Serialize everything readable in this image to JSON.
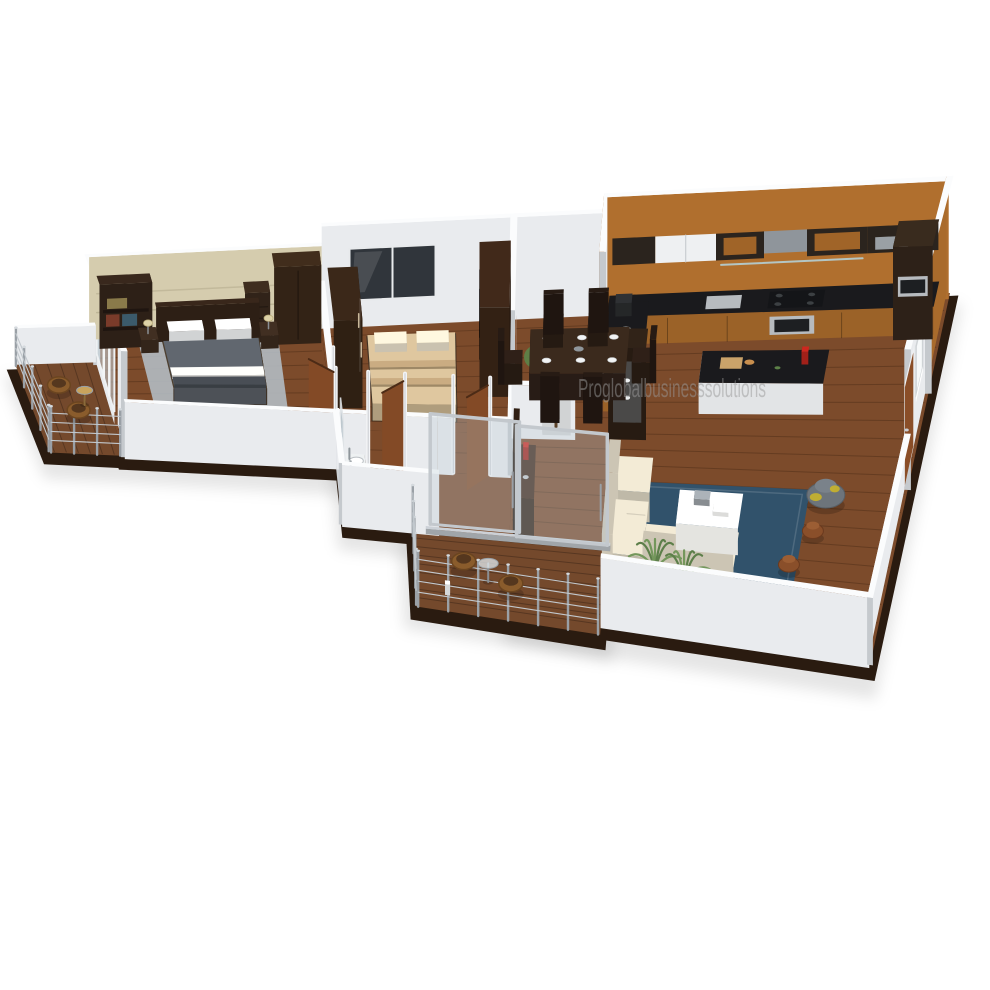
{
  "watermark": {
    "text": "Proglobalbusinesssolutions"
  },
  "scene": {
    "description": "3D isometric dollhouse render of a 2BHK apartment floor plan on a white background",
    "rooms": [
      {
        "name": "master-bedroom",
        "objects": [
          "double-bed",
          "gray-duvet",
          "white-pillows",
          "area-rug",
          "bookshelf",
          "dresser",
          "wardrobe",
          "nightstands",
          "table-lamps",
          "sliding-window",
          "wallpaper-accent-wall"
        ]
      },
      {
        "name": "master-balcony",
        "objects": [
          "wood-deck",
          "cable-railing",
          "wicker-chairs",
          "round-table"
        ]
      },
      {
        "name": "bedroom-2",
        "objects": [
          "double-bed",
          "beige-bedding",
          "wardrobe",
          "mirrored-wardrobe",
          "window"
        ]
      },
      {
        "name": "hallway",
        "objects": [
          "open-wooden-doors"
        ]
      },
      {
        "name": "bathroom",
        "objects": [
          "washbasin-vanity",
          "mirror",
          "tile-floor"
        ]
      },
      {
        "name": "kitchen",
        "objects": [
          "l-shaped-counter",
          "black-countertop",
          "upper-cabinets",
          "cooker-hood",
          "hob",
          "oven-column",
          "kitchen-island",
          "red-bottle",
          "coffee-maker",
          "kettle"
        ]
      },
      {
        "name": "dining-area",
        "objects": [
          "six-seater-table",
          "dining-chairs",
          "place-settings",
          "crockery-cabinet",
          "indoor-tree"
        ]
      },
      {
        "name": "living-area",
        "objects": [
          "sectional-sofa",
          "white-coffee-table",
          "blue-rug",
          "bean-bag",
          "poufs",
          "palm-plants",
          "skateboard",
          "tv-console"
        ]
      },
      {
        "name": "front-balcony",
        "objects": [
          "glass-sliding-doors",
          "wood-deck",
          "cable-railing",
          "wicker-chairs",
          "round-glass-table"
        ]
      },
      {
        "name": "entry",
        "objects": [
          "entry-door",
          "wall-window-opening"
        ]
      }
    ]
  },
  "palette": {
    "wallFace": "#e9ebee",
    "wallTop": "#fbfcfd",
    "wallSide": "#c5c9cd",
    "wallpaper": "#d5ccae",
    "woodFloor": "#7c4b2b",
    "deck": "#74492c",
    "kitchenWood": "#b06f2e",
    "counterTop": "#1a1a1d",
    "islandBase": "#e9eaec",
    "dark": "#38261a",
    "door": "#8a4e28",
    "tableWood": "#2e2019",
    "rug": "#31526b",
    "masterRug": "#b4bec6",
    "sofa": "#d9d2bf",
    "duvet": "#575c63",
    "pillow": "#eef0f1",
    "bedding": "#c7b28e",
    "tile": "#cdd1d4",
    "glass": "rgba(190,205,215,0.32)",
    "steel": "#a9afb5",
    "bean": "#6d747b",
    "beanYellow": "#c9b42a",
    "plant": "#5d7f4a",
    "plantDark": "#4f7040",
    "pouf": "#8a4f2a",
    "slab": "#2a1b10",
    "watermark": "#9a9a9a"
  }
}
